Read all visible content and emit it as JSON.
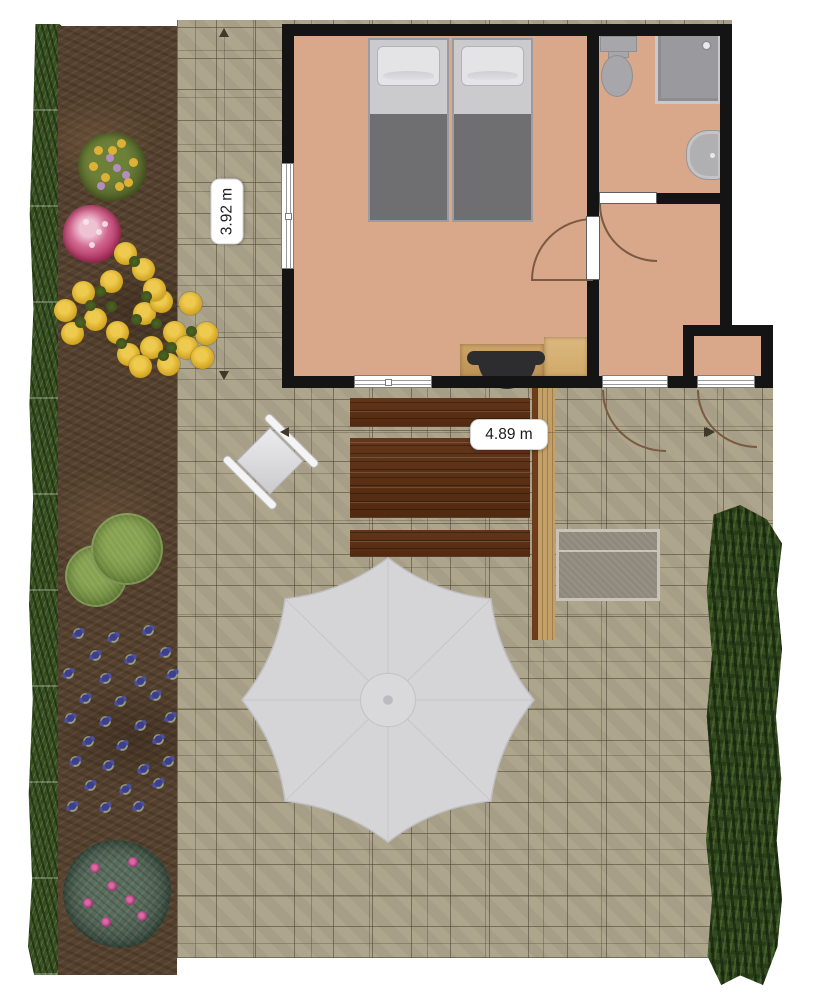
{
  "plan": {
    "type": "floor-plan-with-garden",
    "measurements": {
      "vertical_label": "3.92 m",
      "horizontal_label": "4.89 m"
    }
  },
  "palette": {
    "wall": "#141414",
    "floor": "#d9a78a",
    "paving": "#b2aa92",
    "soil": "#55412e",
    "hedge": "#3a5124",
    "hedge2": "#33491f",
    "wood_dark": "#6f3d1c",
    "wood_light": "#c3a067",
    "fixture": "#a7a7ab",
    "mat": "#8e887d",
    "matline": "#c8c3b8",
    "doorline": "#7b5a42",
    "label_text": "#1c1c1c"
  },
  "garden": {
    "scatters": [
      {
        "host": "garden-layer",
        "cls": "flower-yellow",
        "item_name": "yellow-flower",
        "size": 23,
        "points": [
          [
            125,
            253
          ],
          [
            143,
            269
          ],
          [
            111,
            281
          ],
          [
            83,
            292
          ],
          [
            65,
            310
          ],
          [
            95,
            319
          ],
          [
            72,
            333
          ],
          [
            117,
            332
          ],
          [
            144,
            313
          ],
          [
            161,
            301
          ],
          [
            174,
            332
          ],
          [
            151,
            347
          ],
          [
            128,
            354
          ],
          [
            186,
            347
          ],
          [
            202,
            357
          ],
          [
            168,
            364
          ],
          [
            190,
            303
          ],
          [
            206,
            333
          ],
          [
            154,
            289
          ],
          [
            140,
            366
          ]
        ]
      },
      {
        "host": "garden-layer",
        "cls": "leaf-dot",
        "item_name": "leaf-tuft",
        "size": 11,
        "points": [
          [
            134,
            261
          ],
          [
            100,
            291
          ],
          [
            80,
            322
          ],
          [
            121,
            343
          ],
          [
            156,
            323
          ],
          [
            171,
            347
          ],
          [
            146,
            296
          ],
          [
            191,
            331
          ],
          [
            111,
            306
          ],
          [
            136,
            319
          ],
          [
            163,
            355
          ],
          [
            90,
            305
          ]
        ]
      },
      {
        "host": "garden-layer",
        "cls": "flower-blue",
        "item_name": "blue-flower",
        "size": 15,
        "points": [
          [
            78,
            633
          ],
          [
            113,
            637
          ],
          [
            148,
            630
          ],
          [
            95,
            655
          ],
          [
            130,
            659
          ],
          [
            165,
            652
          ],
          [
            68,
            673
          ],
          [
            105,
            678
          ],
          [
            140,
            681
          ],
          [
            172,
            674
          ],
          [
            85,
            698
          ],
          [
            120,
            701
          ],
          [
            155,
            695
          ],
          [
            70,
            718
          ],
          [
            105,
            721
          ],
          [
            140,
            725
          ],
          [
            170,
            717
          ],
          [
            88,
            741
          ],
          [
            122,
            745
          ],
          [
            158,
            739
          ],
          [
            75,
            761
          ],
          [
            108,
            765
          ],
          [
            143,
            769
          ],
          [
            168,
            761
          ],
          [
            90,
            785
          ],
          [
            125,
            789
          ],
          [
            158,
            783
          ],
          [
            105,
            807
          ],
          [
            138,
            806
          ],
          [
            72,
            806
          ]
        ]
      },
      {
        "host": "garden-layer",
        "cls": "flower-magenta",
        "item_name": "magenta-flower",
        "size": 10,
        "points": [
          [
            95,
            868
          ],
          [
            133,
            862
          ],
          [
            112,
            886
          ],
          [
            88,
            903
          ],
          [
            130,
            900
          ],
          [
            106,
            922
          ],
          [
            142,
            916
          ]
        ]
      },
      {
        "host": "garden-layer",
        "cls": "dot-yellow",
        "item_name": "bush-yellow-dot",
        "size": 9,
        "points": [
          [
            98,
            150
          ],
          [
            121,
            143
          ],
          [
            133,
            162
          ],
          [
            105,
            177
          ],
          [
            119,
            186
          ],
          [
            93,
            166
          ],
          [
            112,
            150
          ],
          [
            128,
            182
          ]
        ]
      },
      {
        "host": "garden-layer",
        "cls": "dot-violet",
        "item_name": "bush-violet-dot",
        "size": 8,
        "points": [
          [
            110,
            158
          ],
          [
            126,
            175
          ],
          [
            101,
            186
          ],
          [
            117,
            168
          ]
        ]
      },
      {
        "host": "garden-layer",
        "cls": "dot-white",
        "item_name": "pinkbush-highlight",
        "size": 6,
        "points": [
          [
            86,
            222
          ],
          [
            99,
            232
          ],
          [
            92,
            245
          ],
          [
            105,
            224
          ]
        ]
      }
    ]
  }
}
